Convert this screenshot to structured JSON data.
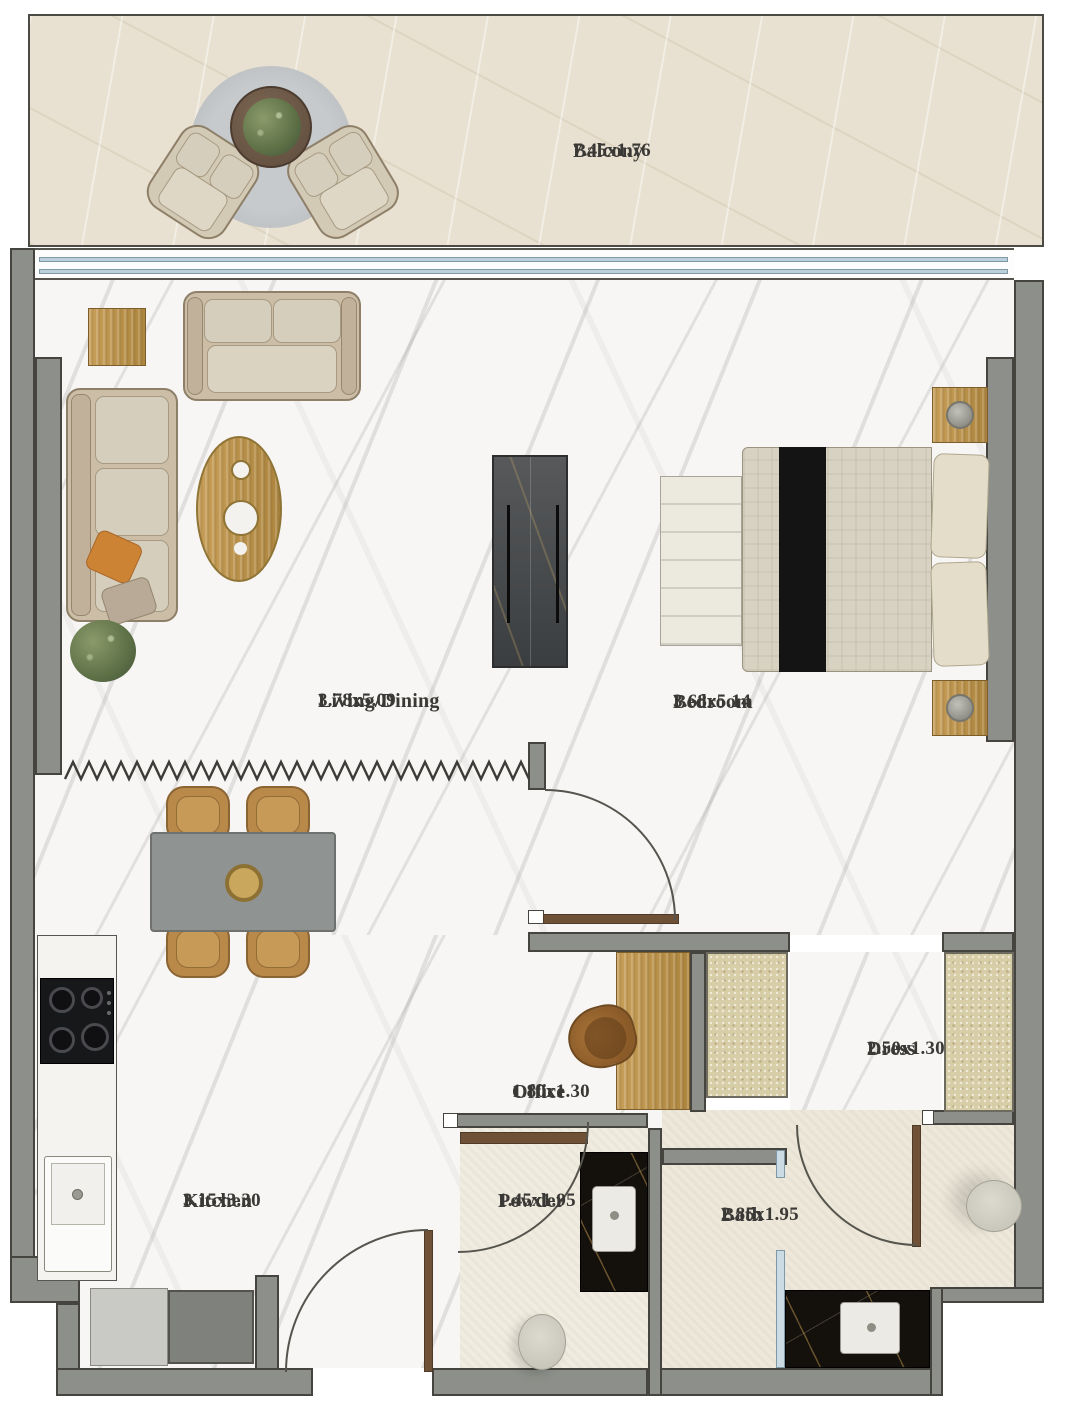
{
  "floorplan": {
    "rooms": [
      {
        "key": "balcony",
        "name": "Balcony",
        "dims": "7.45x1.76"
      },
      {
        "key": "living_dining",
        "name": "Living/Dining",
        "dims": "3.78x5.09"
      },
      {
        "key": "bedroom",
        "name": "Bedroom",
        "dims": "3.68x5.14"
      },
      {
        "key": "kitchen",
        "name": "Kitchen",
        "dims": "3.15x3.30"
      },
      {
        "key": "office",
        "name": "Office",
        "dims": "1.80x1.30"
      },
      {
        "key": "powder",
        "name": "Powder",
        "dims": "1.45x1.95"
      },
      {
        "key": "bath",
        "name": "Bath",
        "dims": "2.85x1.95"
      },
      {
        "key": "dress",
        "name": "Dress",
        "dims": "2.50x1.30"
      }
    ],
    "colors": {
      "wall": "#8d908a",
      "wall_outline": "#45443f",
      "gold_wood": "#c49a55",
      "glass_blue": "#bcd0da",
      "black_marble": "#16120e",
      "beige_floor": "#ede8da",
      "balcony_floor": "#e8e0d0",
      "white_marble": "#f7f6f4",
      "door_wood": "#6e5136",
      "label_text": "#3a3936"
    }
  }
}
